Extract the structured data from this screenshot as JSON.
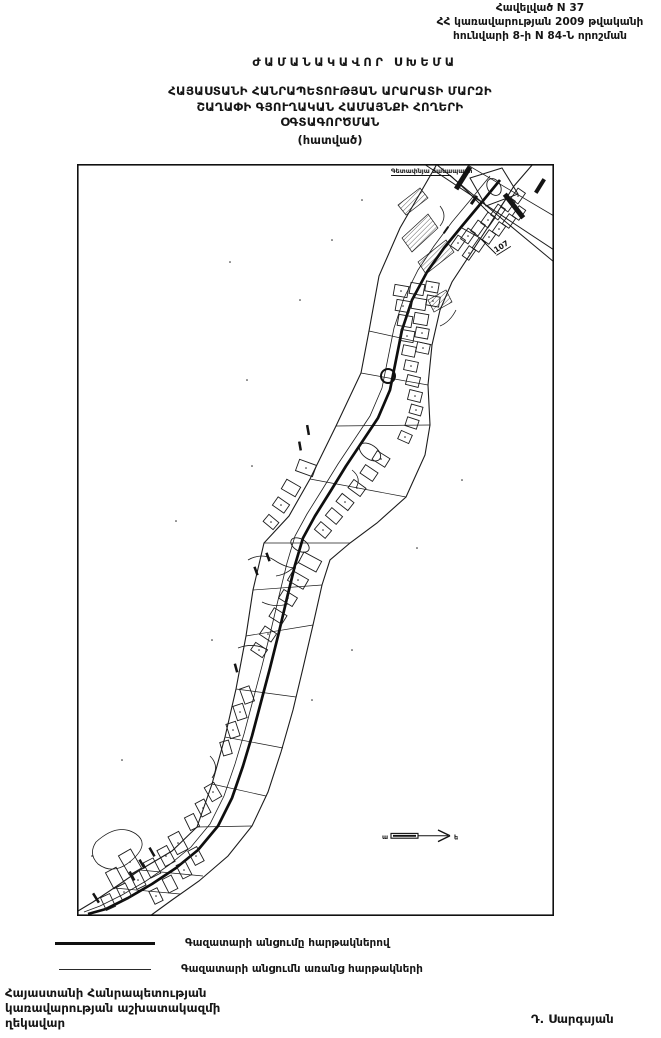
{
  "header": {
    "lines": [
      "Հավելված N 37",
      "ՀՀ կառավարության 2009 թվականի",
      "հունվարի 8-ի N 84-Ն որոշման"
    ]
  },
  "title": {
    "kicker": "ԺԱՄԱՆԱԿԱՎՈՐ ՍԽԵՄԱ",
    "lines": [
      "ՀԱՅԱՍՏԱՆԻ ՀԱՆՐԱՊԵՏՈՒԹՅԱՆ ԱՐԱՐԱՏԻ ՄԱՐԶԻ",
      "ՇԱՂԱՓԻ ԳՅՈՒՂԱԿԱՆ ՀԱՄԱՅՆՔԻ ՀՈՂԵՐԻ",
      "ՕԳՏԱԳՈՐԾՄԱՆ"
    ],
    "subtitle": "(հատված)"
  },
  "map": {
    "labels": {
      "road": "Գետափնյա ճանապարհ",
      "parcel": "107"
    },
    "compass": {
      "left": "ա",
      "right": "ե"
    }
  },
  "legend": {
    "items": [
      {
        "line": "thick",
        "label": "Գազատարի անցումը հարթակներով"
      },
      {
        "line": "thin",
        "label": "Գազատարի անցումն առանց հարթակների"
      }
    ]
  },
  "footer": {
    "lines": [
      "Հայաստանի Հանրապետության",
      "կառավարության աշխատակազմի",
      "ղեկավար"
    ],
    "signature": "Դ. Սարգսյան"
  },
  "colors": {
    "ink": "#161616",
    "paper": "#ffffff"
  }
}
